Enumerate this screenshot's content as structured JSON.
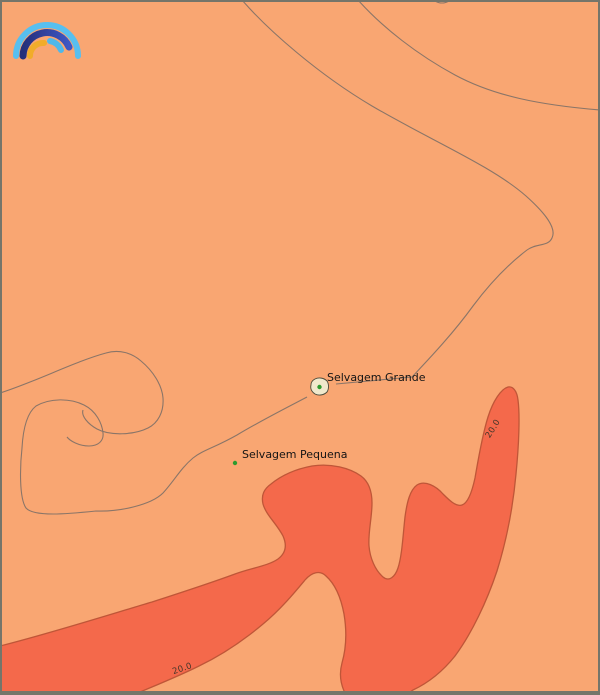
{
  "map": {
    "type": "contour-temperature-map",
    "place_labels": [
      {
        "name": "Selvagem Grande"
      },
      {
        "name": "Selvagem Pequena"
      }
    ],
    "contour_labels": [
      {
        "value": "20.0",
        "position": "right-ridge"
      },
      {
        "value": "20.0",
        "position": "bottom-band"
      }
    ],
    "colors": {
      "background": "#f9a672",
      "warm_region": "#f4694b",
      "warm_region_border": "#bf5638",
      "contour_line": "#8a7568",
      "frame": "#75756a",
      "island_fill": "#f0e9cc",
      "island_marker": "#2e9b2e",
      "label_text": "#141414",
      "contour_label_text": "#43362a"
    }
  },
  "logo": {
    "name": "rainbow-arcs-logo",
    "outer_arc": "#58bfef",
    "middle_arc_start": "#252f7a",
    "middle_arc_end": "#3d56c4",
    "inner_left_arc": "#f1ac2a",
    "inner_right_arc": "#4fb8ea"
  }
}
